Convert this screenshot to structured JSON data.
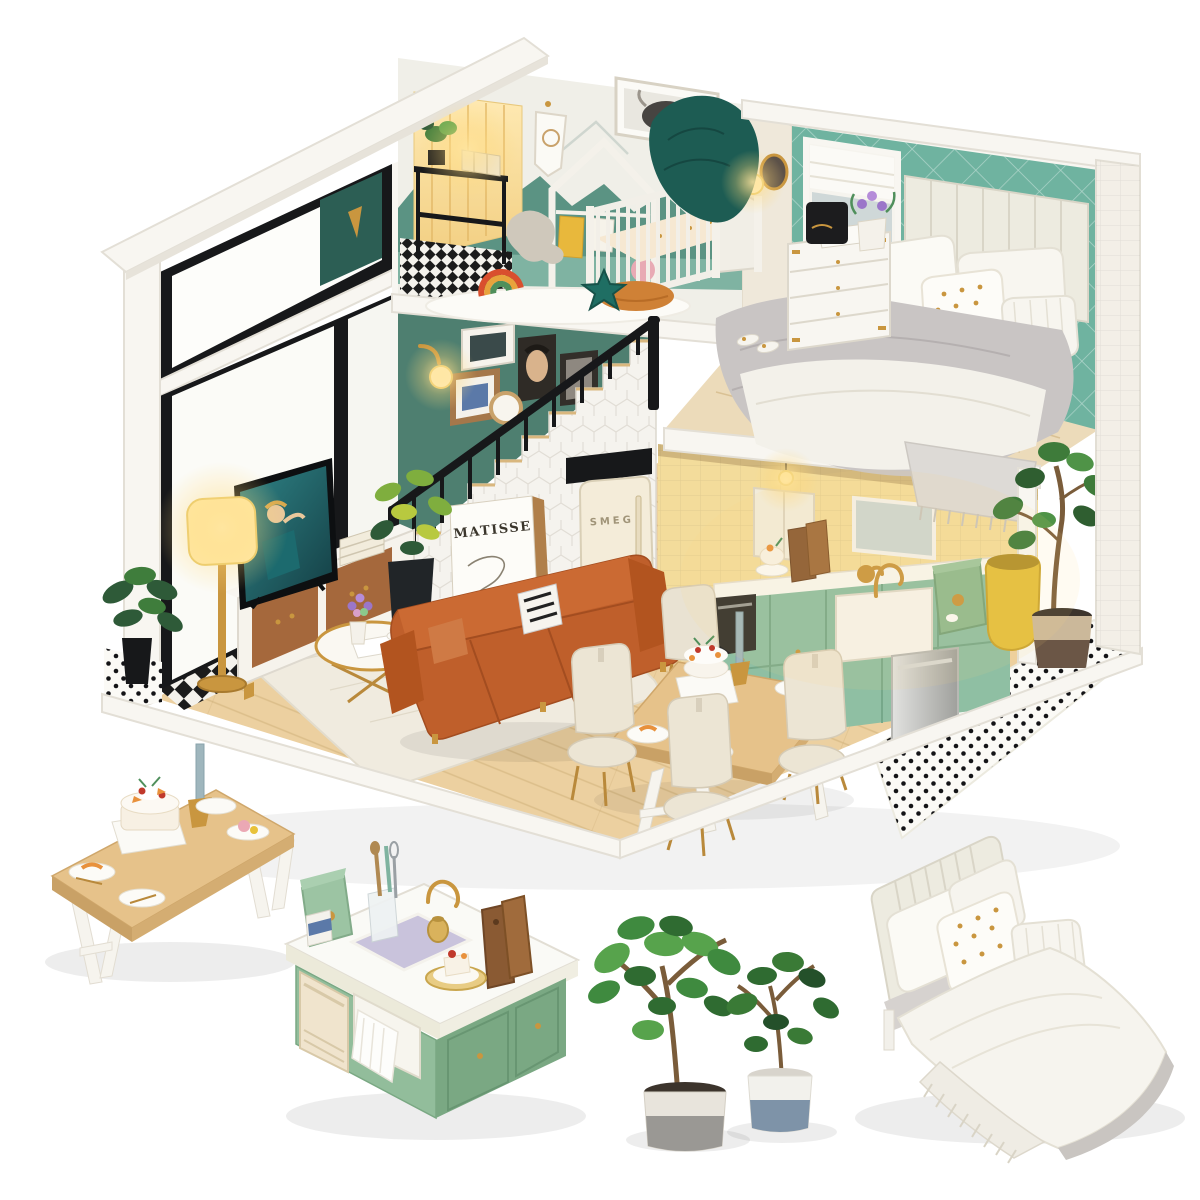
{
  "photo": {
    "background": "#ffffff",
    "subject": "DIY miniature dollhouse loft kit product photo with four standalone furniture vignettes"
  },
  "texts": {
    "poster_title": "MATISSE",
    "fridge_logo": "SMEG"
  },
  "palette": {
    "roof_white": "#f8f6f1",
    "window_frame_black": "#17181a",
    "bedroom_wall_teal": "#6fb3a0",
    "gallery_wall_green": "#4e7f70",
    "kitchen_wall_yellow": "#f3dc9b",
    "cabinet_mint": "#8fbfa3",
    "island_green": "#92bd9b",
    "wood_floor": "#ecd0a0",
    "table_wood": "#e6c28a",
    "sofa_cognac": "#bf5f2b",
    "lamp_glow": "#ffe59e",
    "accent_gold": "#c9963f",
    "blanket_green": "#1d5c53",
    "plant_green": "#3f8a3f",
    "bedding_white": "#f6f4ee",
    "blanket_gray": "#c9c5c4"
  },
  "scene": {
    "house_rooms": [
      "nursery loft",
      "master bedroom loft",
      "staircase with gallery wall",
      "living room",
      "dining area",
      "kitchen"
    ],
    "standalone_items": [
      "wooden dining table with cakes",
      "kitchen island with farmhouse sink",
      "two potted fiddle-leaf fig plants",
      "upholstered double bed"
    ]
  }
}
